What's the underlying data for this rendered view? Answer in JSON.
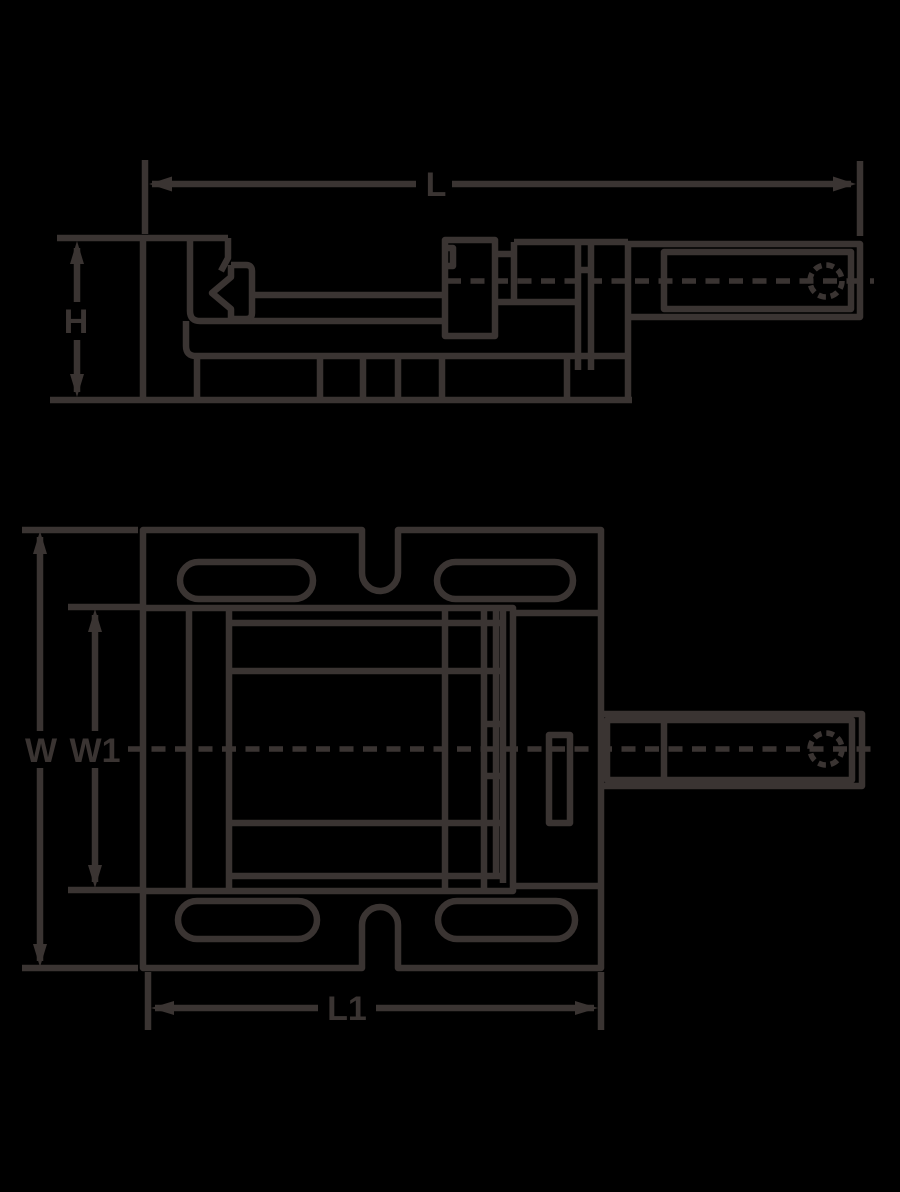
{
  "diagram": {
    "labels": {
      "L": "L",
      "H": "H",
      "W": "W",
      "W1": "W1",
      "L1": "L1"
    },
    "colors": {
      "background": "#000000",
      "line": "#3a3432"
    }
  }
}
